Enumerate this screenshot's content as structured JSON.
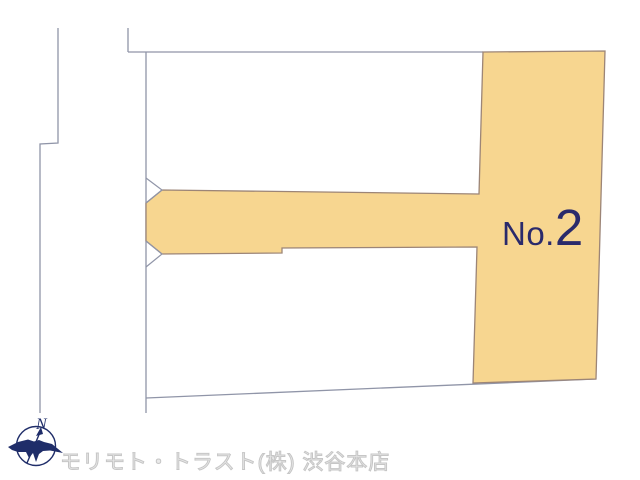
{
  "lot": {
    "label_prefix": "No.",
    "label_number": "2",
    "label_full": "No.2",
    "fill_color": "#F7D690",
    "outline_color": "#9C8577",
    "label_color": "#2A2A6B"
  },
  "map": {
    "parcel_line_color": "#9095A8",
    "background_color": "#FFFFFF"
  },
  "compass": {
    "north_label": "N",
    "color": "#1F2D69"
  },
  "footer": {
    "company": "モリモト・トラスト(株) 渋谷本店",
    "text_color": "#C6C6C6"
  }
}
